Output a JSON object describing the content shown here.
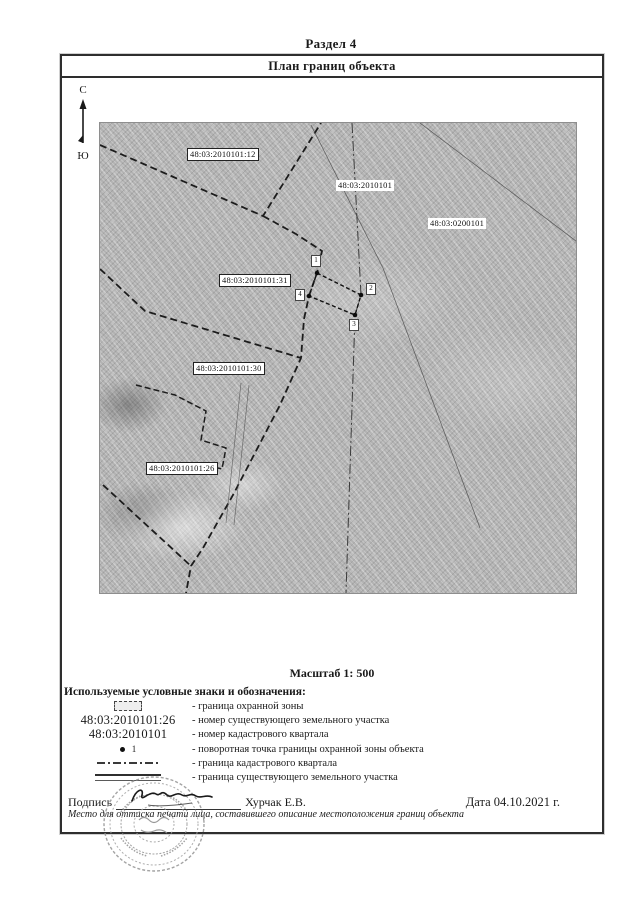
{
  "page": {
    "section_title": "Раздел 4"
  },
  "panel": {
    "title": "План границ объекта"
  },
  "compass": {
    "north_label": "С",
    "south_label": "Ю"
  },
  "map": {
    "labels": [
      {
        "text": "48:03:2010101:12"
      },
      {
        "text": "48:03:2010101"
      },
      {
        "text": "48:03:0200101"
      },
      {
        "text": "48:03:2010101:31"
      },
      {
        "text": "48:03:2010101:30"
      },
      {
        "text": "48:03:2010101:26"
      }
    ],
    "points": [
      {
        "n": "1"
      },
      {
        "n": "2"
      },
      {
        "n": "3"
      },
      {
        "n": "4"
      }
    ]
  },
  "scale_text": "Масштаб 1: 500",
  "legend": {
    "heading": "Используемые условные знаки и обозначения:",
    "rows": [
      {
        "label": "- граница охранной зоны"
      },
      {
        "symbol_text": "48:03:2010101:26",
        "label": "- номер существующего земельного участка"
      },
      {
        "symbol_text": "48:03:2010101",
        "label": "- номер кадастрового квартала"
      },
      {
        "point_number": "1",
        "label": "- поворотная точка границы охранной зоны объекта"
      },
      {
        "label": "- граница кадастрового квартала"
      },
      {
        "label": "- граница существующего земельного участка"
      }
    ]
  },
  "signature": {
    "label": "Подпись",
    "name": "Хурчак Е.В.",
    "date_text": "Дата 04.10.2021 г.",
    "note": "Место для оттиска печати лица, составившего описание местоположения границ объекта"
  },
  "colors": {
    "line_dark": "#1c1c1c",
    "stamp_gray": "#9a9a9a",
    "photo_gray": "#b2b2b2"
  }
}
